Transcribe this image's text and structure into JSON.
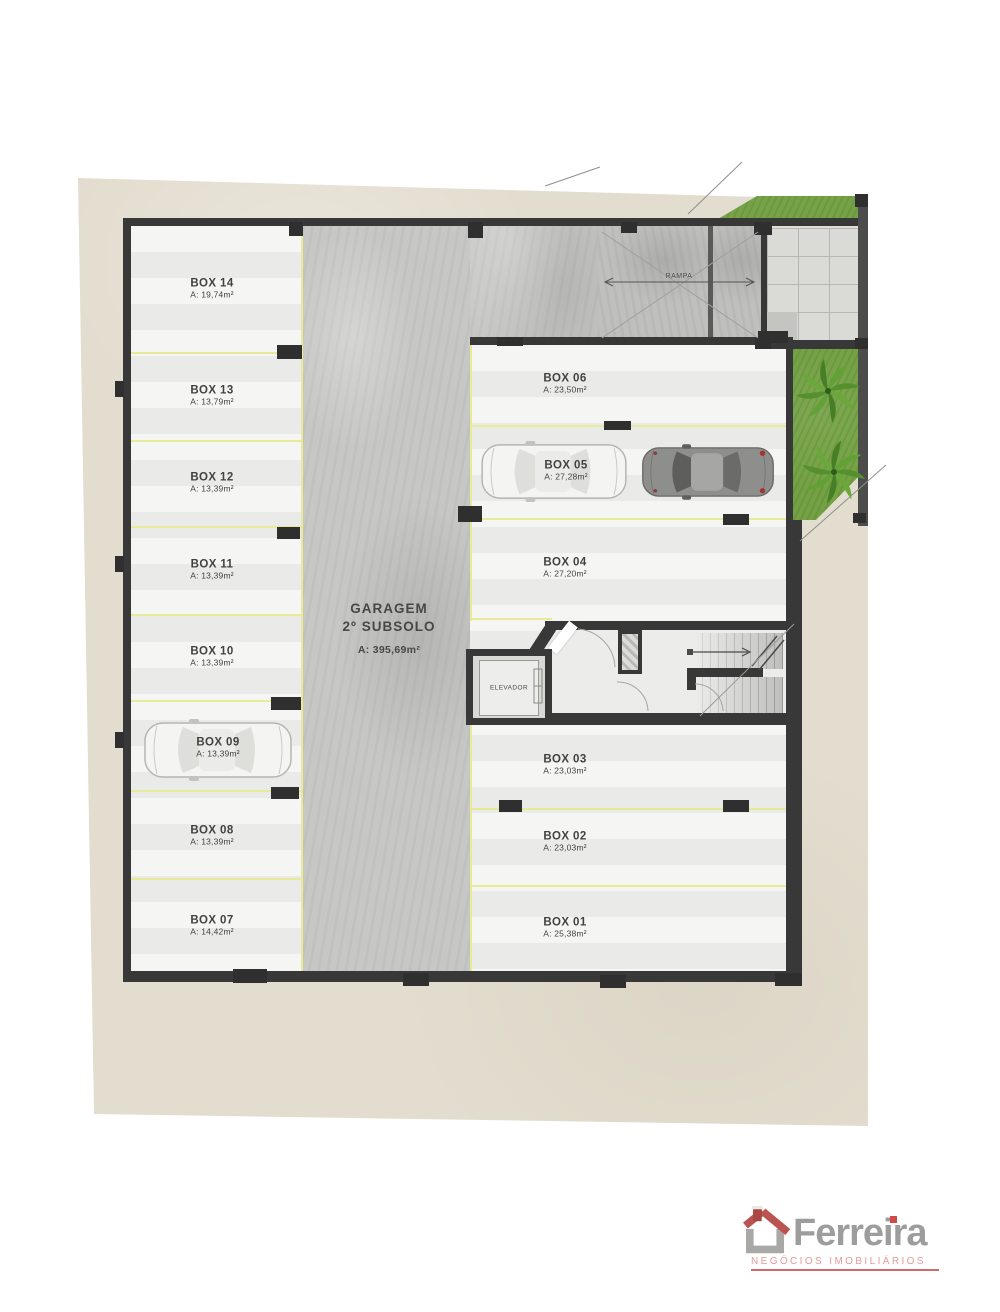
{
  "plan": {
    "garage": {
      "line1": "GARAGEM",
      "line2": "2º SUBSOLO",
      "area": "A: 395,69m²"
    },
    "ramp_label": "RAMPA",
    "elevator_label": "ELEVADOR",
    "left_boxes": [
      {
        "label": "BOX 14",
        "area": "A: 19,74m²"
      },
      {
        "label": "BOX 13",
        "area": "A: 13,79m²"
      },
      {
        "label": "BOX 12",
        "area": "A: 13,39m²"
      },
      {
        "label": "BOX 11",
        "area": "A: 13,39m²"
      },
      {
        "label": "BOX 10",
        "area": "A: 13,39m²"
      },
      {
        "label": "BOX 09",
        "area": "A: 13,39m²"
      },
      {
        "label": "BOX 08",
        "area": "A: 13,39m²"
      },
      {
        "label": "BOX 07",
        "area": "A: 14,42m²"
      }
    ],
    "right_boxes": [
      {
        "label": "BOX 06",
        "area": "A: 23,50m²"
      },
      {
        "label": "BOX 05",
        "area": "A: 27,28m²"
      },
      {
        "label": "BOX 04",
        "area": "A: 27,20m²"
      },
      {
        "label": "BOX 03",
        "area": "A: 23,03m²"
      },
      {
        "label": "BOX 02",
        "area": "A: 23,03m²"
      },
      {
        "label": "BOX 01",
        "area": "A: 25,38m²"
      }
    ]
  },
  "logo": {
    "brand": "Ferreira",
    "tagline": "NEGÓCIOS IMOBILIÁRIOS"
  },
  "colors": {
    "sand": "#e3ddcf",
    "floor": "#f0f0ee",
    "concrete": "#c7c7c5",
    "wall": "#383838",
    "stall_line": "#e9e997",
    "grass": "#73a143",
    "paver": "#dadad7",
    "logo_gray": "#9d9d9d",
    "logo_red": "#bb5350",
    "logo_pink": "#e29b99"
  }
}
